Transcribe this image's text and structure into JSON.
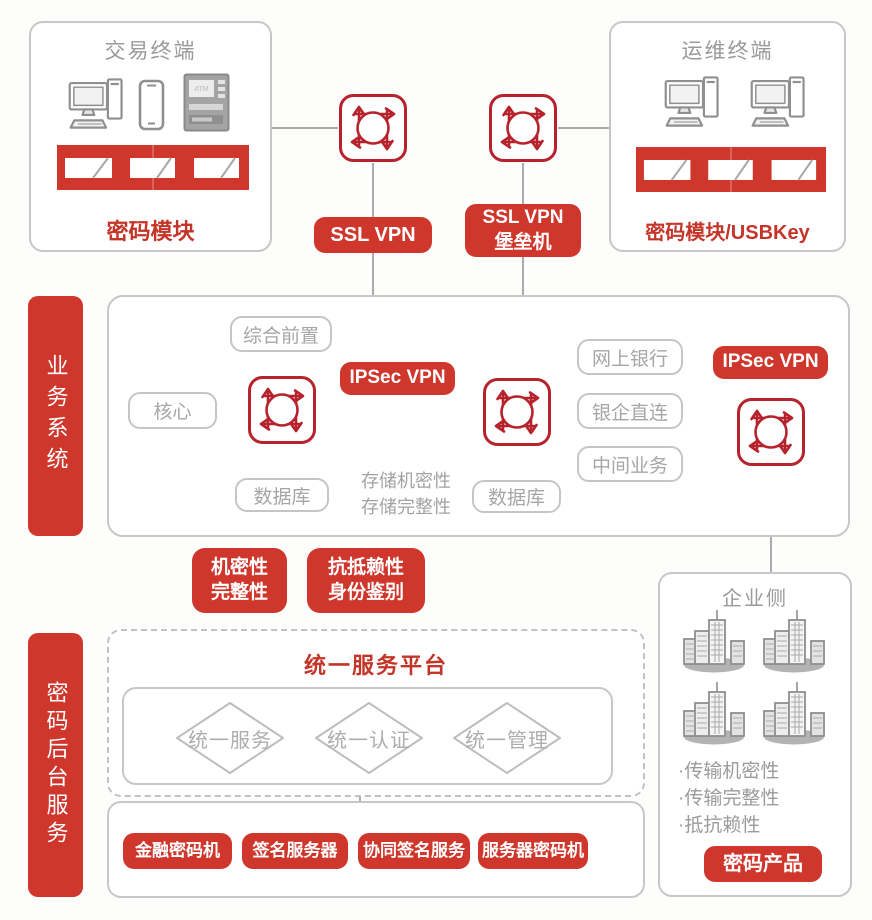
{
  "palette": {
    "red": "#cf372c",
    "icon_red": "#b6232c",
    "red_text": "#c43529",
    "gray_border": "#c7c7c7",
    "gray_text": "#9d9d9d",
    "line_gray": "#ababab"
  },
  "icons": {
    "vpn_gateway": "circular-arrows-gateway",
    "desktop": "desktop-computer",
    "phone": "smartphone",
    "atm": "atm-machine",
    "building": "office-building",
    "module_bar": "crypto-module-bar"
  },
  "top": {
    "trade_terminal": {
      "title": "交易终端",
      "module_label": "密码模块",
      "atm_label": "ATM"
    },
    "ops_terminal": {
      "title": "运维终端",
      "module_label": "密码模块/USBKey"
    },
    "ssl_vpn_label": "SSL VPN",
    "bastion_line1": "SSL VPN",
    "bastion_line2": "堡垒机"
  },
  "business": {
    "tab": "业务系统",
    "front": "综合前置",
    "core": "核心",
    "db1": "数据库",
    "db2": "数据库",
    "ebank": "网上银行",
    "bank_direct": "银企直连",
    "middle_biz": "中间业务",
    "ipsec1": "IPSec VPN",
    "ipsec2": "IPSec VPN",
    "storage1": "存储机密性",
    "storage2": "存储完整性"
  },
  "badges": {
    "confidentiality": "机密性",
    "integrity": "完整性",
    "non_repudiation": "抗抵赖性",
    "identity": "身份鉴别"
  },
  "backend": {
    "tab": "密码后台服务",
    "platform_title": "统一服务平台",
    "diamonds": [
      "统一服务",
      "统一认证",
      "统一管理"
    ],
    "servers": [
      "金融密码机",
      "签名服务器",
      "协同签名服务",
      "服务器密码机"
    ]
  },
  "enterprise": {
    "title": "企业侧",
    "bullets": [
      "·传输机密性",
      "·传输完整性",
      "·抵抗赖性"
    ],
    "product_label": "密码产品"
  }
}
